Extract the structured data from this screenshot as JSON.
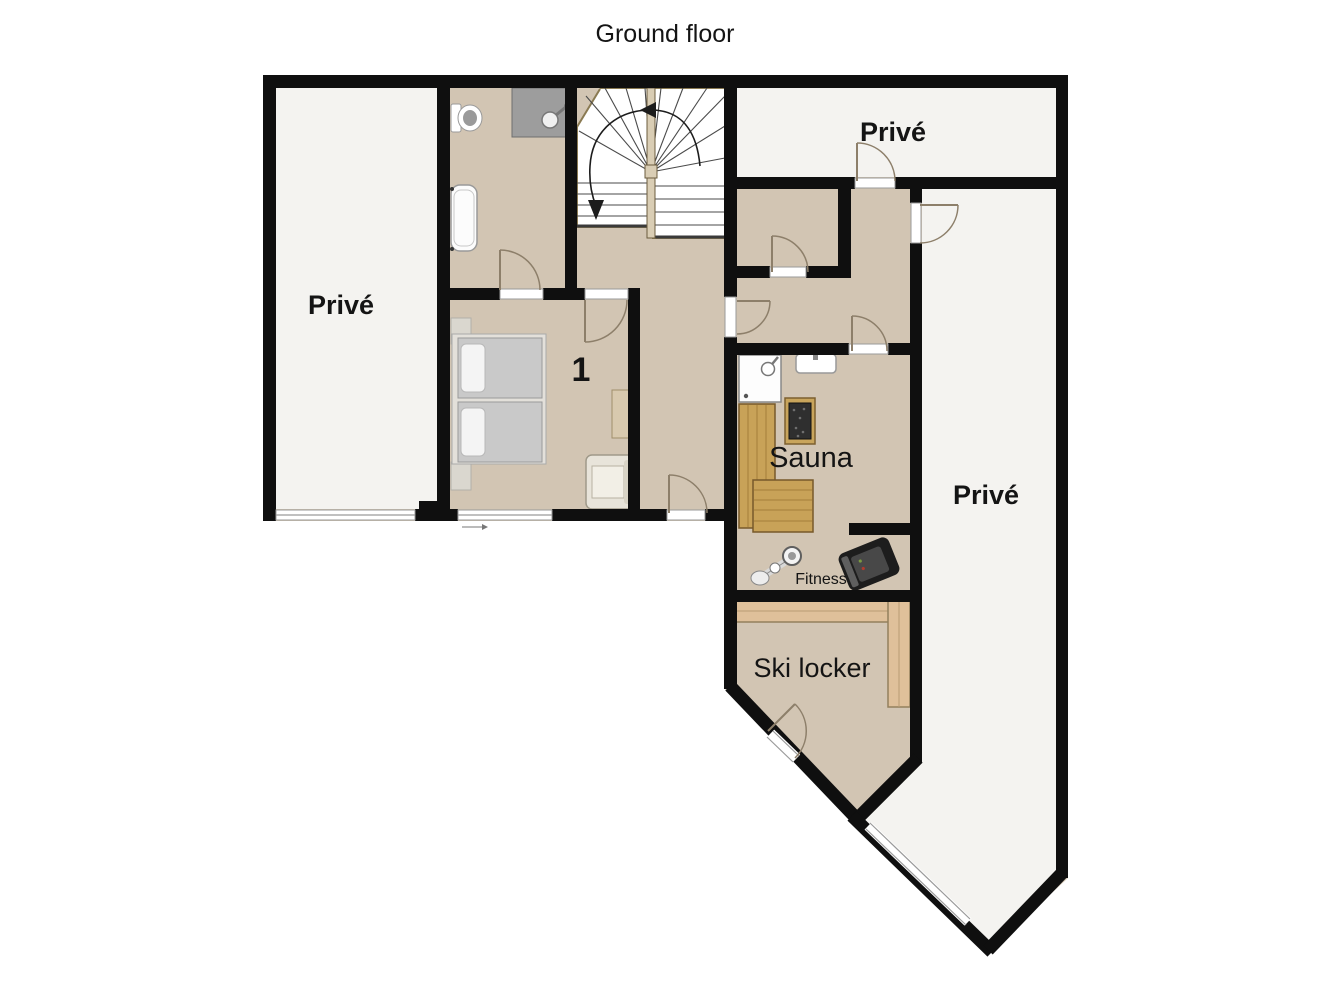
{
  "title": "Ground floor",
  "rooms": {
    "prive_left": {
      "label": "Privé"
    },
    "prive_top": {
      "label": "Privé"
    },
    "prive_right": {
      "label": "Privé"
    },
    "bedroom": {
      "number": "1"
    },
    "sauna": {
      "label": "Sauna"
    },
    "fitness": {
      "label": "Fitness"
    },
    "ski_locker": {
      "label": "Ski locker"
    }
  },
  "colors": {
    "wall": "#0f0f0f",
    "floor": "#d2c5b3",
    "private_floor": "#f4f3f0",
    "wood_bench": "#c8a258",
    "wood_shelf": "#dfc09a",
    "door_swing": "#8d7f6a",
    "text": "#141414"
  }
}
